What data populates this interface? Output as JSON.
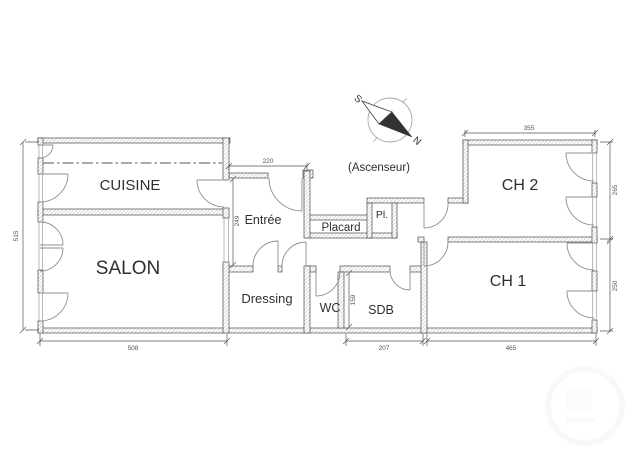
{
  "rooms": {
    "cuisine": {
      "label": "CUISINE"
    },
    "salon": {
      "label": "SALON"
    },
    "entree": {
      "label": "Entrée"
    },
    "dressing": {
      "label": "Dressing"
    },
    "wc": {
      "label": "WC"
    },
    "sdb": {
      "label": "SDB"
    },
    "placard": {
      "label": "Placard"
    },
    "pl": {
      "label": "Pl."
    },
    "ch1": {
      "label": "CH 1"
    },
    "ch2": {
      "label": "CH 2"
    }
  },
  "annotations": {
    "ascenseur": "(Ascenseur)"
  },
  "compass": {
    "north": "N",
    "south": "S"
  },
  "dimensions": {
    "plan_height": "515",
    "salon_width": "508",
    "sdb_width": "207",
    "ch1_width": "465",
    "entree_width": "220",
    "entree_height": "249",
    "ch2_width": "355",
    "ch2_height": "265",
    "ch1_height": "250",
    "sdb_height": "159"
  },
  "colors": {
    "wall_outline": "#4a4a4a",
    "hatch_line": "#7a7a7a",
    "door_line": "#8f8f8f",
    "text": "#2f2f2f",
    "dim_text": "#555555",
    "background": "#ffffff"
  }
}
